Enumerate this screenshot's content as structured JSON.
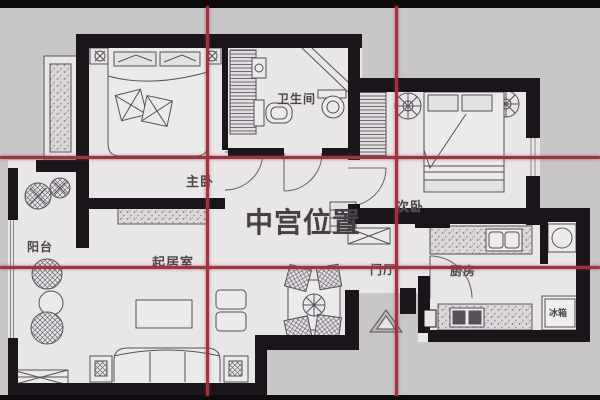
{
  "title": "apartment-floor-plan-nine-palace-grid",
  "overlay": {
    "center_label": "中宫位置",
    "grid_color": "#9d3540",
    "grid_rows": 3,
    "grid_cols": 3
  },
  "rooms": {
    "master_bedroom": "主卧",
    "bathroom": "卫生间",
    "second_bedroom": "次卧",
    "balcony": "阳台",
    "living_room": "起居室",
    "entrance_hall": "门厅",
    "kitchen": "厨房",
    "refrigerator": "冰箱"
  },
  "colors": {
    "background": "#c9c7c8",
    "plan_paper": "#e9e6e7",
    "walls": "#1a151a",
    "furniture_line": "#55505a",
    "grid_red": "#9d3540",
    "label_text": "#4b464b"
  }
}
